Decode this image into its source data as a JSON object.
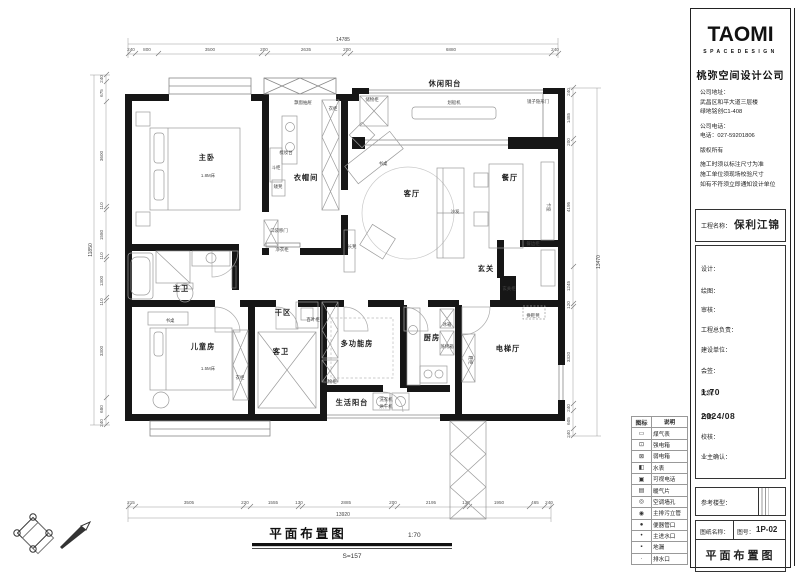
{
  "drawing": {
    "footer": {
      "title": "平面布置图",
      "scale": "1:70",
      "area": "S=157"
    },
    "dims": {
      "top": {
        "total": "14785",
        "segments": [
          "240",
          "800",
          "3500",
          "200",
          "2635",
          "200",
          "6880",
          "240"
        ]
      },
      "bottom": {
        "total": "13920",
        "segments": [
          "215",
          "3505",
          "220",
          "1555",
          "130",
          "2885",
          "200",
          "2195",
          "135",
          "1950",
          "465",
          "240"
        ]
      },
      "left": {
        "total": "11850",
        "segments": [
          "240",
          "675",
          "3600",
          "110",
          "1580",
          "110",
          "1300",
          "110",
          "3300",
          "680",
          "240"
        ]
      },
      "right": {
        "total": "13470",
        "segments": [
          "240",
          "1485",
          "200",
          "4195",
          "1245",
          "120",
          "3320",
          "240",
          "605",
          "240"
        ]
      }
    },
    "labels": {
      "master_bedroom": "主卧",
      "bed_18": "1.8M床",
      "chest": "斗柜",
      "dressing_table": "梳妆台",
      "stool": "矮凳",
      "cloakroom": "衣帽间",
      "bay_drawer": "飘窗抽屉",
      "wardrobe_top": "衣柜",
      "master_bath": "主卫",
      "pocket_door": "口袋移门",
      "clean_cabinet": "净衣柜",
      "leisure_balcony": "休闲阳台",
      "storage_balcony": "储物柜",
      "rowing_machine": "划船机",
      "mirror_door": "镜子隐形门",
      "desk_living": "书桌",
      "living": "客厅",
      "sofa": "沙发",
      "dining": "餐厅",
      "booth": "卡座",
      "sideboard": "餐边柜",
      "bench": "长凳",
      "foyer": "玄关",
      "foyer_cabinet": "玄关柜",
      "shoe_stool": "换鞋凳",
      "dry_area": "干区",
      "kids_room": "儿童房",
      "bed_15": "1.5M床",
      "kids_desk": "书桌",
      "guest_bath": "客卫",
      "wardrobe_kids": "衣柜",
      "louver_cabinet": "百叶柜",
      "multi_room": "多功能房",
      "storage_multi": "储物柜",
      "service_balcony": "生活阳台",
      "washer": "洗衣机",
      "dryer": "烘干机",
      "kitchen": "厨房",
      "fridge": "冰箱",
      "steam_oven": "蒸烤箱",
      "elevator_hall": "电梯厅",
      "shoe_cabinet": "鞋柜"
    }
  },
  "legend": {
    "header": {
      "icon": "图标",
      "desc": "说明"
    },
    "items": [
      {
        "glyph": "▭",
        "label": "煤气表"
      },
      {
        "glyph": "⊡",
        "label": "强电箱"
      },
      {
        "glyph": "⊠",
        "label": "弱电箱"
      },
      {
        "glyph": "◧",
        "label": "水表"
      },
      {
        "glyph": "▣",
        "label": "可视电话"
      },
      {
        "glyph": "▤",
        "label": "暖气片"
      },
      {
        "glyph": "◎",
        "label": "空调墙孔"
      },
      {
        "glyph": "◉",
        "label": "主排污立管"
      },
      {
        "glyph": "●",
        "label": "便器管口"
      },
      {
        "glyph": "•",
        "label": "主进水口"
      },
      {
        "glyph": "▪",
        "label": "地漏"
      },
      {
        "glyph": "·",
        "label": "排水口"
      }
    ]
  },
  "title_block": {
    "logo": "TAOMI",
    "logo_sub": "SPACEDESIGN",
    "company": "桃弥空间设计公司",
    "address_label": "公司地址：",
    "address_line1": "武昌区和平大道三层楼",
    "address_line2": "绿地铭创C1-408",
    "phone_label": "公司电话：",
    "phone": "电话：027-59201806",
    "copyright": "版权所有",
    "note1": "施工时须以标注尺寸为准",
    "note2": "施工单位须现场校验尺寸",
    "note3": "如有不符须立即通知设计单位",
    "project_label": "工程名称：",
    "project_name": "保利江锦",
    "field_design": "设计：",
    "field_draw": "绘图：",
    "field_review": "审核：",
    "field_chief": "工程总负责：",
    "field_builder": "建设单位：",
    "field_sign": "会签：",
    "scale_label": "比例:",
    "scale_value": "1:70",
    "date_label": "日期:",
    "date_value": "2024/08",
    "field_check": "校核：",
    "field_owner": "业主确认：",
    "ref_label": "参考楼型：",
    "sheet_name_label": "图纸名称：",
    "sheet_no_label": "图号：",
    "sheet_no": "1P-02",
    "sheet_name": "平面布置图"
  }
}
